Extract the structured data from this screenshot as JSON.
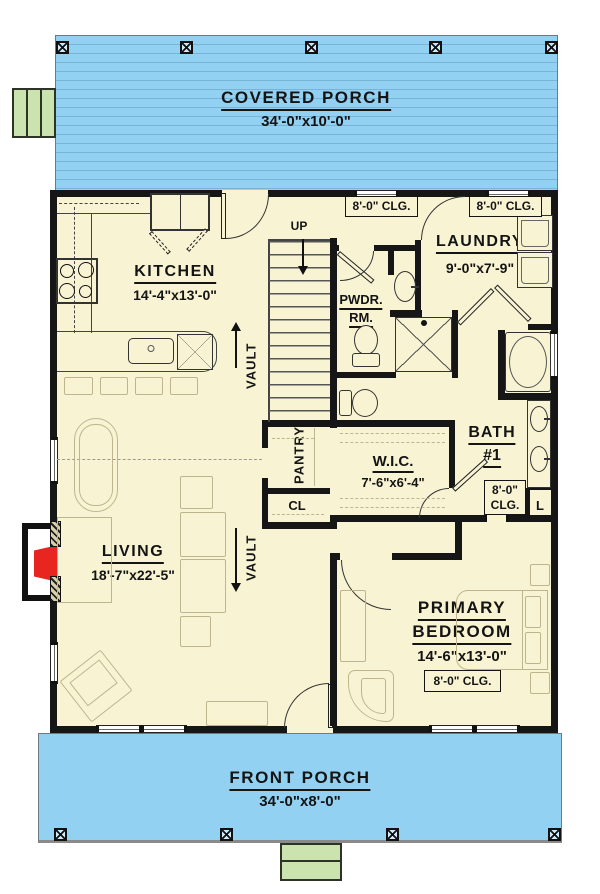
{
  "plan": {
    "covered_porch": {
      "name": "COVERED PORCH",
      "dims": "34'-0\"x10'-0\""
    },
    "front_porch": {
      "name": "FRONT PORCH",
      "dims": "34'-0\"x8'-0\""
    },
    "kitchen": {
      "name": "KITCHEN",
      "dims": "14'-4\"x13'-0\""
    },
    "living": {
      "name": "LIVING",
      "dims": "18'-7\"x22'-5\""
    },
    "laundry": {
      "name": "LAUNDRY",
      "dims": "9'-0\"x7'-9\""
    },
    "powder": {
      "line1": "PWDR.",
      "line2": "RM."
    },
    "bath": {
      "line1": "BATH",
      "line2": "#1"
    },
    "wic": {
      "name": "W.I.C.",
      "dims": "7'-6\"x6'-4\""
    },
    "primary": {
      "line1": "PRIMARY",
      "line2": "BEDROOM",
      "dims": "14'-6\"x13'-0\""
    },
    "pantry": "PANTRY",
    "closet": "CL",
    "linen": "L",
    "up": "UP",
    "vault": "VAULT",
    "ceiling_note": "8'-0\" CLG.",
    "ceiling_note_l1": "8'-0\"",
    "ceiling_note_l2": "CLG."
  },
  "colors": {
    "porch_blue": "#93d1f3",
    "interior_cream": "#f8f4d3",
    "step_green": "#cbe3af",
    "fireplace_red": "#e8251f",
    "wall_black": "#161616",
    "furniture_outline": "#beb58e"
  }
}
